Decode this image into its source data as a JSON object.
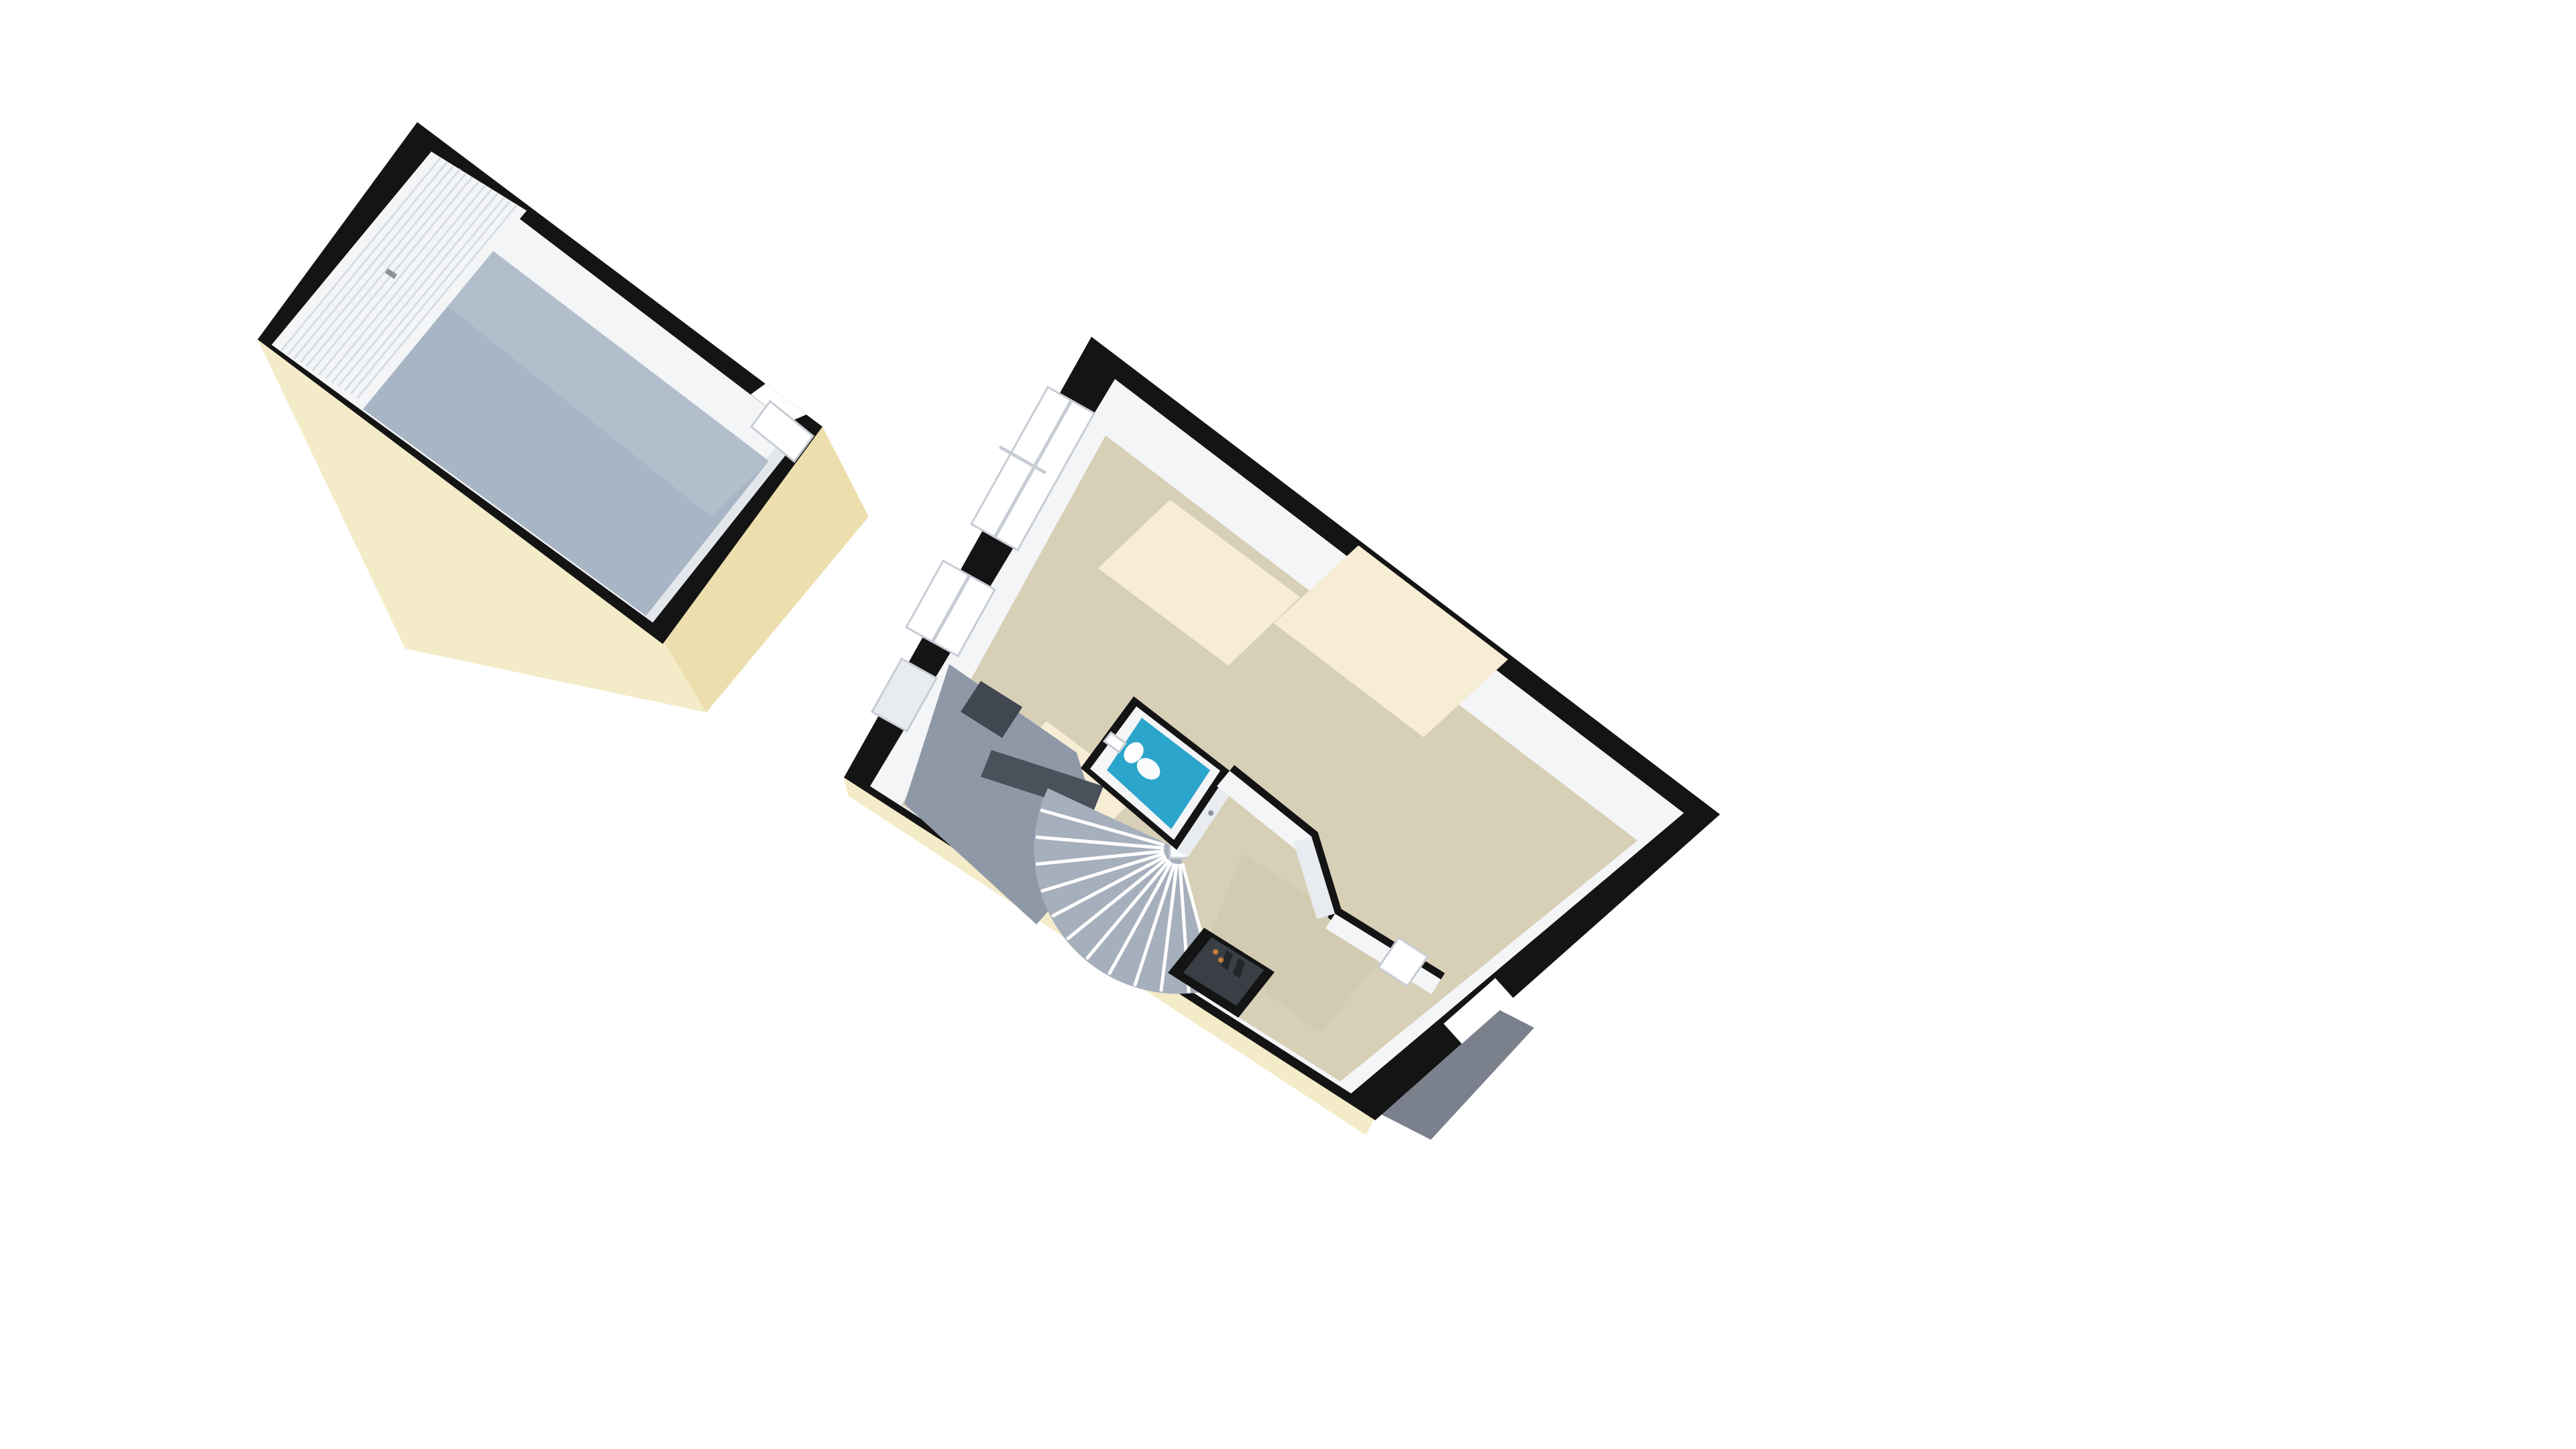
{
  "scene": {
    "type": "3d-floorplan-dollhouse-view",
    "buildings": [
      "garage",
      "house-ground-floor"
    ]
  },
  "colors": {
    "background": "#ffffff",
    "wall": "#141414",
    "cream_light": "#f4ecc8",
    "cream_dark": "#ecdfad",
    "garage_floor": "#a8b5c4",
    "garage_floor_light": "#b9c4d1",
    "interior_white": "#f3f5f7",
    "interior_shadow": "#e8ebef",
    "band_shadow": "#e3e7ec",
    "beige": "#d8cfb7",
    "beige_shadow": "#cfc5ab",
    "sun": "#f7ecd4",
    "wc_blue": "#2ca5cc",
    "white": "#ffffff",
    "stair_gray": "#a6afbc",
    "entry_gray": "#8f98a6",
    "counter_dark": "#414750",
    "counter_mid": "#4a515b",
    "niche_floor": "#3a3f46",
    "item_dark": "#23262a",
    "item_orange": "#c87f3a",
    "mat_gray": "#7b818c",
    "frame": "#c7ccd4",
    "slat": "#d9dde2",
    "handle": "#8d939c",
    "newel": "#fbfcfd",
    "fixture": "#fafbfc"
  }
}
